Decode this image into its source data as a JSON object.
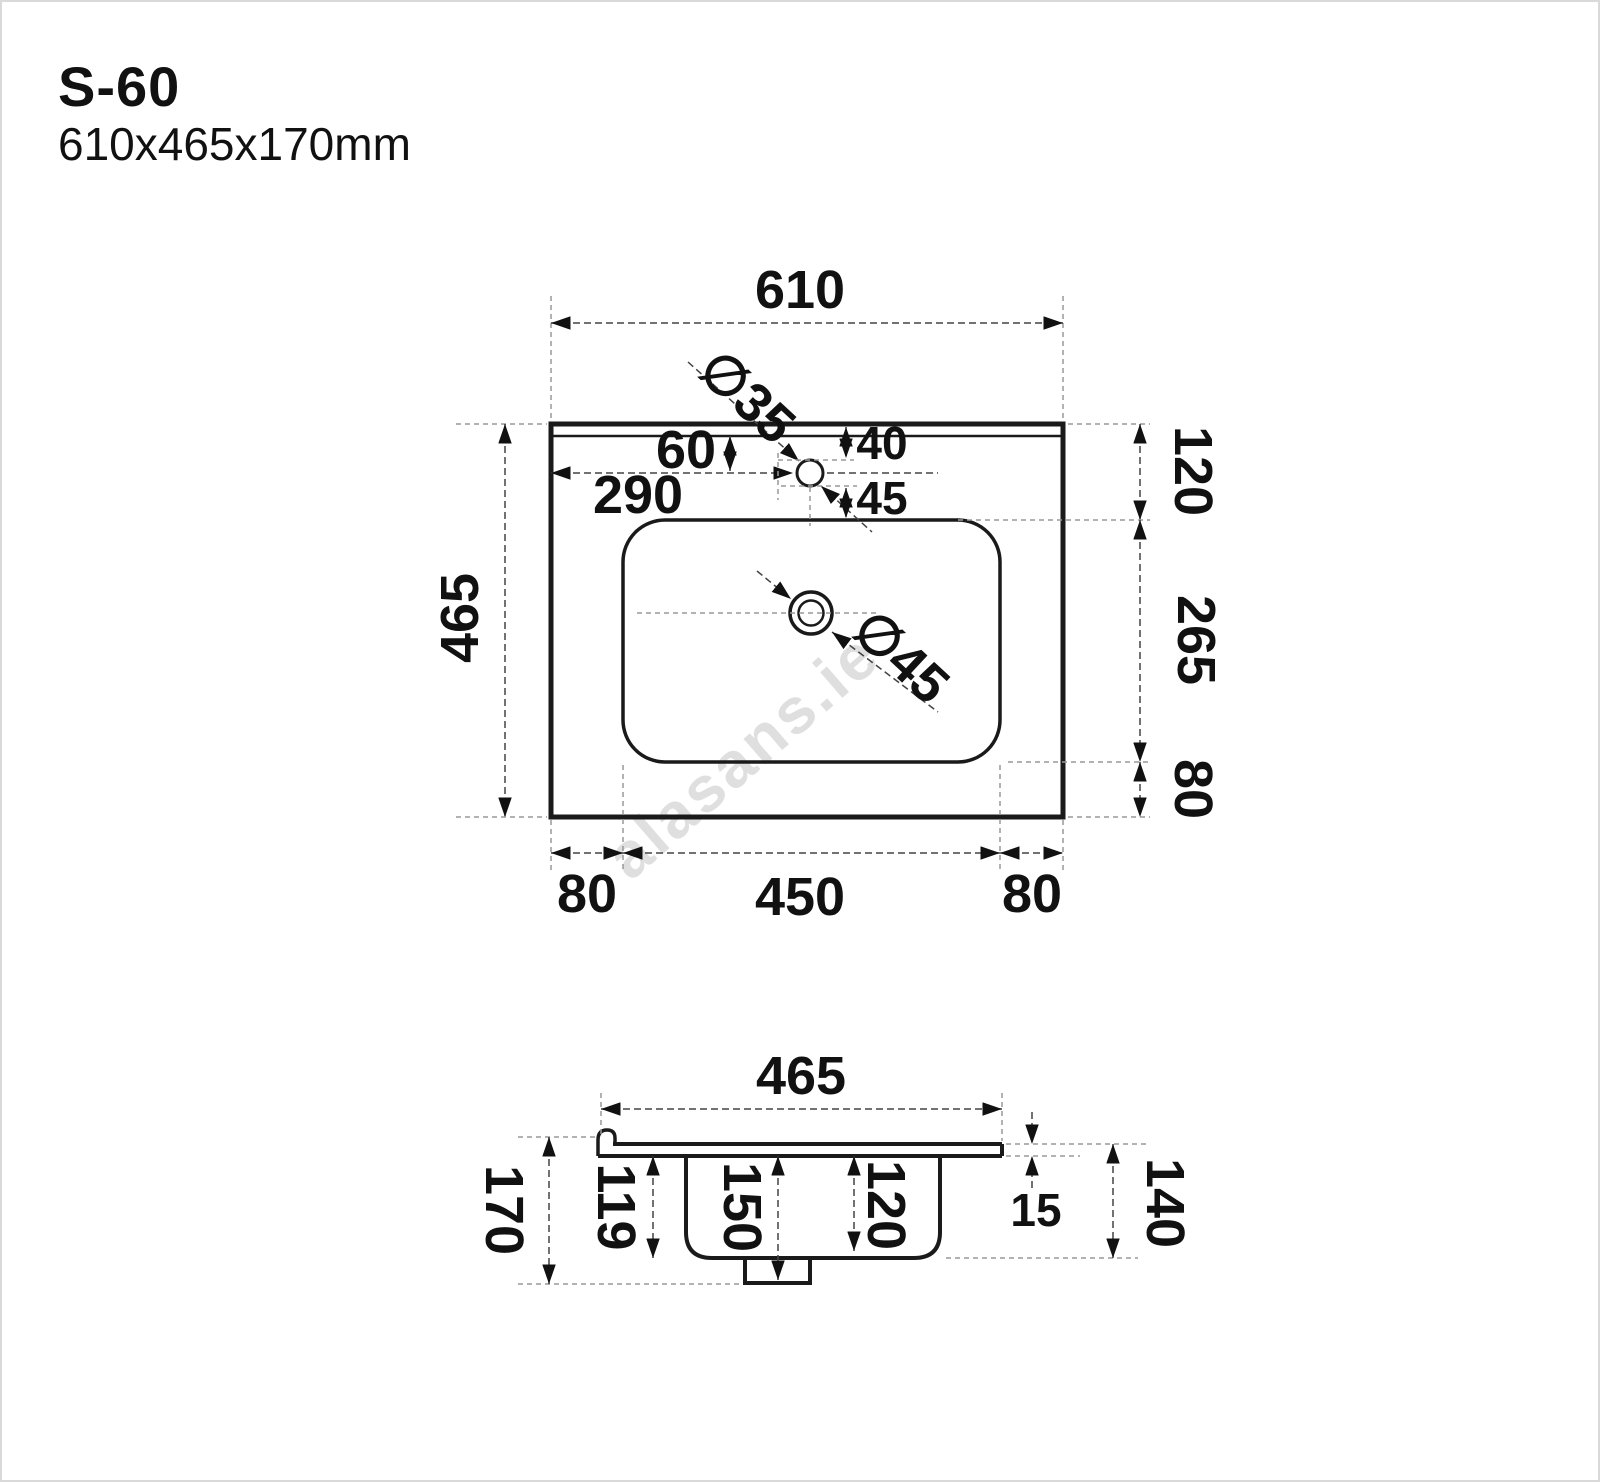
{
  "header": {
    "model": "S-60",
    "size": "610x465x170mm"
  },
  "watermark": "alasans.ie",
  "top_view": {
    "overall_width": "610",
    "overall_depth": "465",
    "faucet_hole_diameter": "∅35",
    "faucet_offset": "60",
    "faucet_from_back": "40",
    "faucet_from_left": "290",
    "faucet_to_basin": "45",
    "back_to_basin": "120",
    "basin_inner_depth": "265",
    "basin_to_front": "80",
    "left_margin": "80",
    "basin_width": "450",
    "right_margin": "80",
    "drain_diameter": "∅45"
  },
  "side_view": {
    "overall_depth": "465",
    "overall_height": "170",
    "bowl_inner_height": "119",
    "height_to_drain": "150",
    "bowl_mid_height": "120",
    "rim_thickness": "15",
    "bowl_height": "140"
  }
}
